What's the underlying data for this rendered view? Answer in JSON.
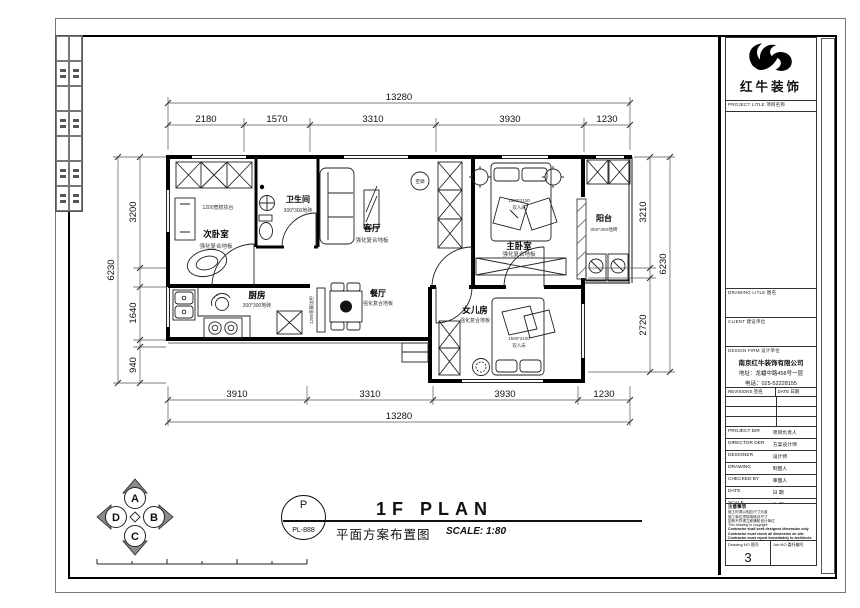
{
  "sheet": {
    "logo_text": "红牛装饰",
    "stamp": {
      "letter": "P",
      "code": "PL-888"
    },
    "footer": {
      "title_en": "1F PLAN",
      "title_cn": "平面方案布置图",
      "scale": "SCALE: 1:80"
    },
    "compass": {
      "n": "A",
      "e": "B",
      "s": "C",
      "w": "D"
    }
  },
  "titleblock": {
    "project_label": "PROJECT LITLE 项目名称",
    "drawing_label": "DRAWING LITLE 图名",
    "client_label": "CLIENT 建设单位",
    "firm_label": "DESIGN FIRM 设计单位",
    "firm_name": "南京红牛装饰有限公司",
    "firm_address": "地址：龙蟠中路458号一层",
    "firm_phone": "电话：025-52228155",
    "rev_label": "REVISIONS 签名",
    "rev_date_label": "DATE 日期",
    "rows": [
      {
        "en": "PROJECT DIR",
        "cn": "项目负责人"
      },
      {
        "en": "DIRECTOR DER",
        "cn": "方案设计师"
      },
      {
        "en": "DESIGNER",
        "cn": "设计师"
      },
      {
        "en": "DRAWING",
        "cn": "制图人"
      },
      {
        "en": "CHECKED BY",
        "cn": "审图人"
      },
      {
        "en": "DATE",
        "cn": "日 期"
      },
      {
        "en": "SCALE",
        "cn": "比 例"
      }
    ],
    "notes_title": "注意事项",
    "notes_cn": [
      "施工时请以相应尺寸为准",
      "施工单位须现场核对尺寸",
      "如有不符请立即通知设计单位"
    ],
    "notes_en": [
      "This drawing is copyright",
      "Contractor shall seek designed dimension only",
      "Contractor must check all dimension on site",
      "Contractor must report immediately to architects"
    ],
    "drawing_no_label": "Drawing NO 图号",
    "drawing_no": "3",
    "job_no_label": "Job NO 委托编号"
  },
  "plan": {
    "rooms": {
      "second_bedroom": {
        "name": "次卧室",
        "floor": "强化复合地板",
        "note": "1200宽梳妆台"
      },
      "bathroom": {
        "name": "卫生间",
        "floor": "300*300地砖"
      },
      "living": {
        "name": "客厅",
        "floor": "强化复合地板"
      },
      "ac_label": "空调",
      "master_bedroom": {
        "name": "主卧室",
        "floor": "强化复合地板",
        "bed_size": "1500*2100",
        "bed_type": "双人床"
      },
      "balcony": {
        "name": "阳台",
        "floor": "300*300地砖"
      },
      "kitchen": {
        "name": "厨房",
        "floor": "300*300地砖"
      },
      "dining": {
        "name": "餐厅",
        "floor": "强化复合地板",
        "note": "1200宽餐边柜"
      },
      "girls_room": {
        "name": "女儿房",
        "floor": "强化复合地板",
        "bed_size": "1500*2100",
        "bed_type": "双人床"
      }
    },
    "dims": {
      "top_total": "13280",
      "top_segments": [
        "2180",
        "1570",
        "3310",
        "3930",
        "1230"
      ],
      "bottom_segments": [
        "3910",
        "3310",
        "3930",
        "1230"
      ],
      "bottom_total": "13280",
      "left_segments": [
        "3200",
        "1640",
        "940"
      ],
      "left_outer": "6230",
      "right_segments": [
        "3210",
        "2720"
      ],
      "right_outer": "6230"
    }
  }
}
